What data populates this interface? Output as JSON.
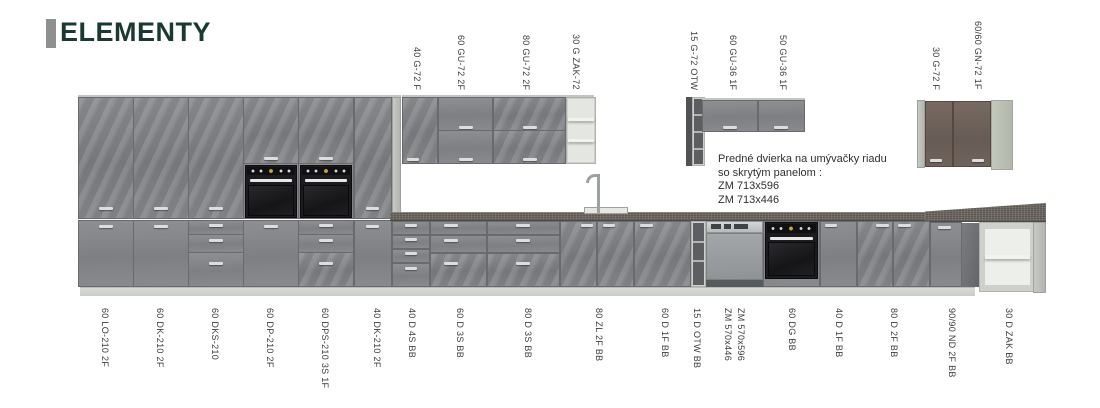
{
  "logo": {
    "text": "ELEMENTY"
  },
  "note": {
    "lines": [
      "Predné dvierka na umývačky riadu",
      "so skrytým panelom :",
      "ZM 713x596",
      "ZM 713x446"
    ]
  },
  "wall_cabinet_labels": [
    {
      "text": "40 G-72 F",
      "x": 412
    },
    {
      "text": "60 GU-72 2F",
      "x": 456
    },
    {
      "text": "80 GU-72 2F",
      "x": 521
    },
    {
      "text": "30 G ZAK-72",
      "x": 571
    },
    {
      "text": "15 G-72 OTW",
      "x": 689
    },
    {
      "text": "60 GU-36 1F",
      "x": 728
    },
    {
      "text": "50 GU-36 1F",
      "x": 778
    },
    {
      "text": "30 G-72 F",
      "x": 931
    },
    {
      "text": "60/60 GN-72 1F",
      "x": 973
    }
  ],
  "base_cabinet_labels": [
    {
      "text": "60 LO-210 2F",
      "x": 100
    },
    {
      "text": "60 DK-210 2F",
      "x": 155
    },
    {
      "text": "60 DKS-210",
      "x": 210
    },
    {
      "text": "60 DP-210 2F",
      "x": 265
    },
    {
      "text": "60 DPS-210 3S 1F",
      "x": 320
    },
    {
      "text": "40 DK-210 2F",
      "x": 372
    },
    {
      "text": "40 D 4S BB",
      "x": 407
    },
    {
      "text": "60 D 3S BB",
      "x": 455
    },
    {
      "text": "80 D 3S BB",
      "x": 523
    },
    {
      "text": "80 ZL 2F BB",
      "x": 594
    },
    {
      "text": "60 D 1F BB",
      "x": 660
    },
    {
      "text": "15 D OTW BB",
      "x": 692
    },
    {
      "text": "ZM 570x446",
      "x": 723
    },
    {
      "text": "ZM 570x596",
      "x": 736
    },
    {
      "text": "60 DG BB",
      "x": 787
    },
    {
      "text": "40 D 1F BB",
      "x": 834
    },
    {
      "text": "80 D 2F BB",
      "x": 889
    },
    {
      "text": "90/90 ND 2F BB",
      "x": 947
    },
    {
      "text": "30 D ZAK BB",
      "x": 1004
    }
  ],
  "colors": {
    "background": "#ffffff",
    "logo_text": "#1b392f",
    "logo_bar": "#8e9090",
    "cabinet_front": "#85868a",
    "cabinet_carcass": "#c3c6c1",
    "corner_door_brown": "#6e615a",
    "countertop": "#6e6862",
    "appliance_black": "#1a1a1e",
    "label_text": "#3c3c3c"
  }
}
